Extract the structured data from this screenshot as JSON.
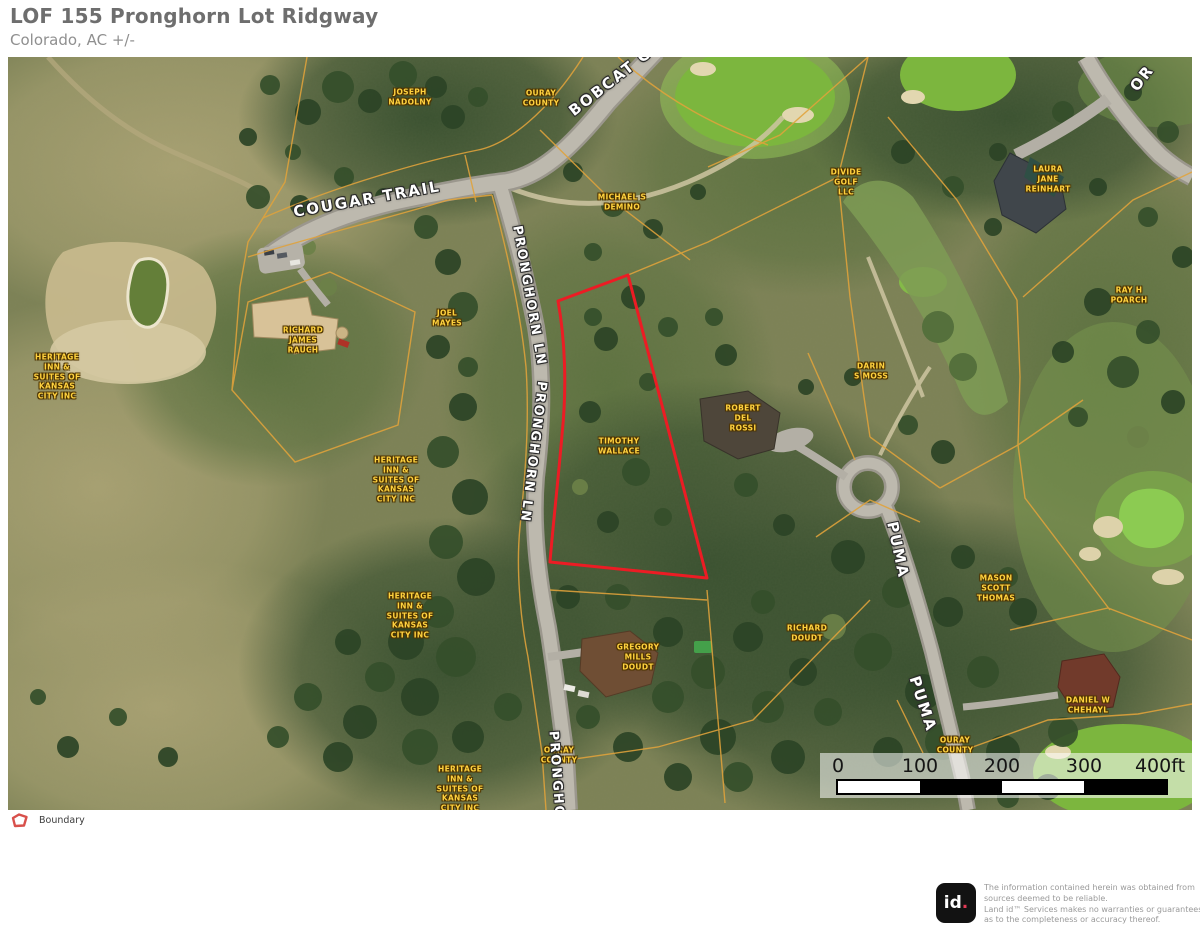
{
  "header": {
    "title": "LOF 155 Pronghorn Lot Ridgway",
    "subtitle": "Colorado,  AC +/-"
  },
  "map": {
    "owner_labels": [
      {
        "text": "JOSEPH\nNADOLNY",
        "x": 402,
        "y": 40
      },
      {
        "text": "OURAY\nCOUNTY",
        "x": 533,
        "y": 41
      },
      {
        "text": "MICHAEL S\nDEMINO",
        "x": 614,
        "y": 145
      },
      {
        "text": "DIVIDE\nGOLF\nLLC",
        "x": 838,
        "y": 125
      },
      {
        "text": "LAURA\nJANE\nREINHART",
        "x": 1040,
        "y": 122
      },
      {
        "text": "RAY H\nPOARCH",
        "x": 1121,
        "y": 238
      },
      {
        "text": "HERITAGE\nINN &\nSUITES OF\nKANSAS\nCITY INC",
        "x": 49,
        "y": 320
      },
      {
        "text": "RICHARD\nJAMES\nRAUCH",
        "x": 295,
        "y": 283
      },
      {
        "text": "JOEL\nMAYES",
        "x": 439,
        "y": 261
      },
      {
        "text": "TIMOTHY\nWALLACE",
        "x": 611,
        "y": 389
      },
      {
        "text": "DARIN\nS MOSS",
        "x": 863,
        "y": 314
      },
      {
        "text": "ROBERT\nDEL\nROSSI",
        "x": 735,
        "y": 361
      },
      {
        "text": "HERITAGE\nINN &\nSUITES OF\nKANSAS\nCITY INC",
        "x": 388,
        "y": 423
      },
      {
        "text": "MASON\nSCOTT\nTHOMAS",
        "x": 988,
        "y": 531
      },
      {
        "text": "HERITAGE\nINN &\nSUITES OF\nKANSAS\nCITY INC",
        "x": 402,
        "y": 559
      },
      {
        "text": "RICHARD\nDOUDT",
        "x": 799,
        "y": 576
      },
      {
        "text": "GREGORY\nMILLS\nDOUDT",
        "x": 630,
        "y": 600
      },
      {
        "text": "DANIEL W\nCHEHAYL",
        "x": 1080,
        "y": 648
      },
      {
        "text": "OURAY\nCOUNTY",
        "x": 947,
        "y": 688
      },
      {
        "text": "OURAY\nCOUNTY",
        "x": 551,
        "y": 698
      },
      {
        "text": "HERITAGE\nINN &\nSUITES OF\nKANSAS\nCITY INC",
        "x": 452,
        "y": 732
      }
    ],
    "street_labels": [
      {
        "text": "COUGAR TRAIL",
        "x": 359,
        "y": 142,
        "rot": -10,
        "size": 15
      },
      {
        "text": "BOBCAT C",
        "x": 602,
        "y": 25,
        "rot": -38,
        "size": 15
      },
      {
        "text": "PRONGHORN LN",
        "x": 521,
        "y": 239,
        "rot": 80,
        "size": 13
      },
      {
        "text": "PRONGHORN LN",
        "x": 525,
        "y": 395,
        "rot": 97,
        "size": 13
      },
      {
        "text": "PRONGHORN LN",
        "x": 550,
        "y": 745,
        "rot": 86,
        "size": 13
      },
      {
        "text": "PUMA",
        "x": 890,
        "y": 493,
        "rot": 78,
        "size": 15
      },
      {
        "text": "PUMA",
        "x": 915,
        "y": 647,
        "rot": 72,
        "size": 15
      },
      {
        "text": "OR",
        "x": 1134,
        "y": 21,
        "rot": -52,
        "size": 15
      }
    ],
    "scale_bar": {
      "ticks": [
        {
          "label": "0",
          "x": 830
        },
        {
          "label": "100",
          "x": 912
        },
        {
          "label": "200",
          "x": 994
        },
        {
          "label": "300",
          "x": 1076
        },
        {
          "label": "400ft",
          "x": 1152
        }
      ]
    }
  },
  "legend": {
    "boundary_label": "Boundary"
  },
  "footer": {
    "logo_text": "id",
    "logo_dot": ".",
    "disclaimer": "The information contained herein was obtained from\nsources deemed to be reliable.\n Land id™  Services makes no warranties or guarantees\nas to the completeness or accuracy thereof."
  },
  "colors": {
    "boundary": "#ec1c24",
    "parcel_line": "#e1a33b",
    "owner_label": "#ffd23f"
  }
}
